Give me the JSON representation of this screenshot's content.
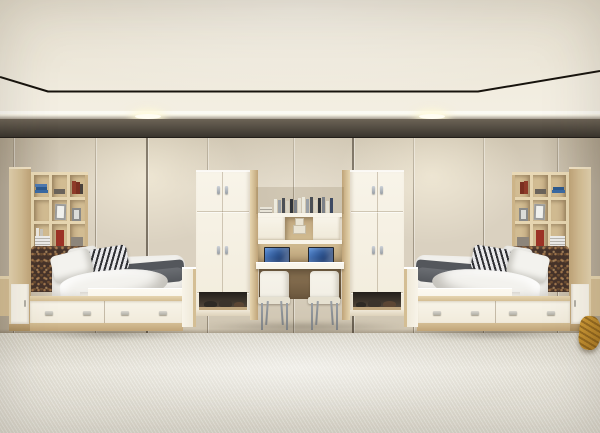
{
  "meta": {
    "title": "Symmetrical twin dormitory bedroom — 3D interior render",
    "visible_text": "none"
  },
  "palette": {
    "ceilingHi": "#f0ebde",
    "ceilingLo": "#e5decd",
    "ceilingLine": "#17130d",
    "soffit": "#f4efe3",
    "lightGlow": "#fffdf2",
    "bandHi": "#6c6356",
    "bandLo": "#3f3a32",
    "wall": "#dad1c0",
    "wallLo": "#cec4b0",
    "floorHi": "#e8e5db",
    "floorLo": "#d6d2c5",
    "wood": "#d4be94",
    "woodHi": "#e6d5b0",
    "woodLo": "#c0a478",
    "cream": "#f8f4e9",
    "shelfBack": "#d2bc92",
    "shelfIn": "#c0a77f",
    "boxTan": "#e9e3d3",
    "headboard": "#46332a",
    "mattress": "#f1f0ec",
    "duvet": "#f3f2ee",
    "blanket": "#6b6e73",
    "blanketDk": "#54575c",
    "stripeDk": "#2f3034",
    "stripeLt": "#e9e9eb",
    "handleMetal": "#b2b0a6",
    "legMetal": "#9aa0a6",
    "laptopFrame": "#23262b",
    "screenHi": "#5a8fd8",
    "screenLo": "#1c3d74",
    "chair": "#f2efe5",
    "chairLo": "#e6e1d1",
    "shoeDark": "#2e2a25",
    "shoeBrown": "#5c4634",
    "throw": "#d19d38",
    "throwDk": "#a87722",
    "bookBlue": "#3a6aa3",
    "bookRed": "#8e3a28",
    "frameGray": "#9c9c9a",
    "shadow": "rgba(52,44,33,0.32)"
  },
  "scene": {
    "room": {
      "ceiling": "flat cream ceiling, recessed panel outlined by thin black shadow gap, bright soffit with two round downlights",
      "wall": "full-height beige panels with vertical seams and a dark shadow cornice at the top",
      "floor": "light woven carpet with diagonal texture"
    },
    "furniture": {
      "left_bed": {
        "headboard_shelf": "light oak open bookshelf holding blue books, red books, picture frames, magazines and a red box",
        "headboard": "dark brown patterned upholstered headboard",
        "bedding": "white duvet, grey folded blanket, one black-and-white striped pillow, two white pillows",
        "base": "white storage drawers with four small metal pulls, oak trim and plinth",
        "side_tower": "oak column with a white lower cabinet door",
        "nightstand": "oak nightstand sliver at the image edge"
      },
      "right_bed": "mirror image of the left bed",
      "wardrobes": "two cream double-door wardrobes with small metal pulls, oak side panels and open base niches holding pairs of shoes",
      "desk_niche": {
        "upper_shelf": "row of standing books on a cream ledge",
        "cabinet_row": "two cream cupboard doors flanking an open cubby with small cardboard boxes",
        "desk": "white shared desktop with two open laptops showing blue screens",
        "chairs": "two white moulded chairs with thin metal legs"
      },
      "accents": {
        "throw": "mustard-yellow draped fabric at the right edge"
      }
    },
    "lighting": {
      "downlight_x": [
        148,
        432
      ],
      "wall_washes": "warm pools below each downlight"
    }
  }
}
